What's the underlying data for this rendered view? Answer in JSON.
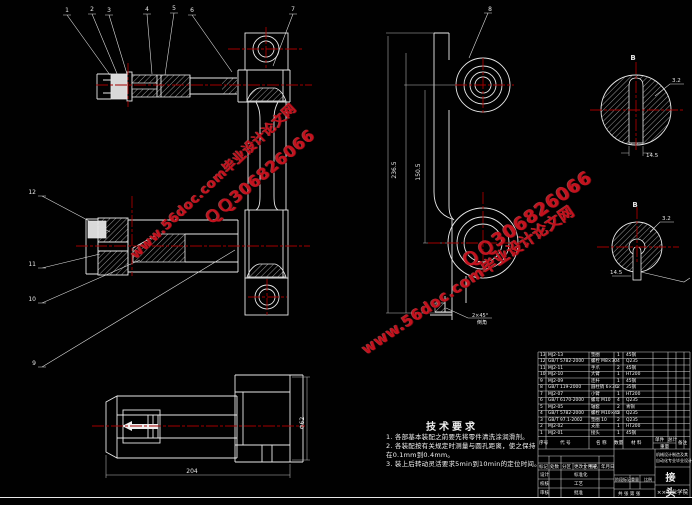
{
  "app": {
    "colors": {
      "background": "#000000",
      "linework": "#e8e8e8",
      "centerline_red": "#a20000",
      "watermark_red": "#c3121e"
    }
  },
  "watermark": {
    "site_line": "www.56doc.com毕业设计论文网",
    "qq_line": "ＱＱ306826066"
  },
  "callouts": {
    "top": [
      "1",
      "2",
      "3",
      "4",
      "5",
      "6",
      "7"
    ],
    "bracket": "8",
    "left": [
      "12",
      "11",
      "10",
      "9"
    ]
  },
  "dimensions": {
    "bracket_outer_height": "236.5",
    "bracket_inner_height": "150.5",
    "slot_top_width": "14.5",
    "slot_top_roughness": "3.2",
    "slot_bottom_width": "14.5",
    "slot_bottom_roughness": "3.2",
    "shaft_length": "204",
    "shaft_diameter": "Φ62",
    "section_label_top": "B",
    "section_label_bottom": "B",
    "foot_note_line1": "2×45°",
    "foot_note_line2": "倒角"
  },
  "tech_requirements": {
    "title": "技术要求",
    "lines": [
      "1. 各部基本装配之前要先将零件清洗涂润滑剂。",
      "2. 各装配按有关规定时测量与圆孔距离，使之保持",
      "   在0.1mm到0.4mm。",
      "3. 装上后转动灵活要求5min到10min的定位时间。"
    ]
  },
  "bom": {
    "headers": [
      "序号",
      "代  号",
      "名  称",
      "数量",
      "材  料",
      "备注"
    ],
    "sub_unit": "单件",
    "sub_total": "总计",
    "weight_header": "重量",
    "rows": [
      [
        "13",
        "MJ2-13",
        "垫圈",
        "1",
        "45钢"
      ],
      [
        "12",
        "GB/T 5782-2000",
        "螺栓 M8×30",
        "4",
        "Q235"
      ],
      [
        "11",
        "MJ2-11",
        "手爪",
        "2",
        "45钢"
      ],
      [
        "10",
        "MJ2-10",
        "大臂",
        "1",
        "HT200"
      ],
      [
        "9",
        "MJ2-09",
        "连杆",
        "1",
        "45钢"
      ],
      [
        "8",
        "GB/T 119-2000",
        "圆柱销 6×30",
        "2",
        "35钢"
      ],
      [
        "7",
        "MJ2-07",
        "小臂",
        "1",
        "HT200"
      ],
      [
        "6",
        "GB/T 6170-2000",
        "螺母 M10",
        "4",
        "Q235"
      ],
      [
        "5",
        "MJ2-05",
        "轴套",
        "2",
        "青铜"
      ],
      [
        "4",
        "GB/T 5782-2000",
        "螺栓 M10×45",
        "2",
        "Q235"
      ],
      [
        "3",
        "GB/T 97.1-2002",
        "垫圈 10",
        "2",
        "Q235"
      ],
      [
        "2",
        "MJ2-02",
        "支座",
        "1",
        "HT200"
      ],
      [
        "1",
        "MJ2-01",
        "接头",
        "1",
        "45钢"
      ]
    ]
  },
  "titleblock": {
    "part_name": "接 头",
    "school": "××工业学院",
    "project_line1": "机械设计制造及其",
    "project_line2": "自动化专业毕业设计",
    "mark_row": "标记",
    "count_row": "处数",
    "zone_row": "分区",
    "change_row": "更改文件号",
    "sign_row": "签名",
    "date_row": "年月日",
    "design": "设计",
    "check": "校核",
    "audit": "审核",
    "standard": "标准化",
    "craft": "工艺",
    "approve": "批准",
    "stage_label": "阶段标记",
    "weight_label": "重量",
    "scale_label": "比例",
    "sheet_label": "共 张 第 张"
  }
}
